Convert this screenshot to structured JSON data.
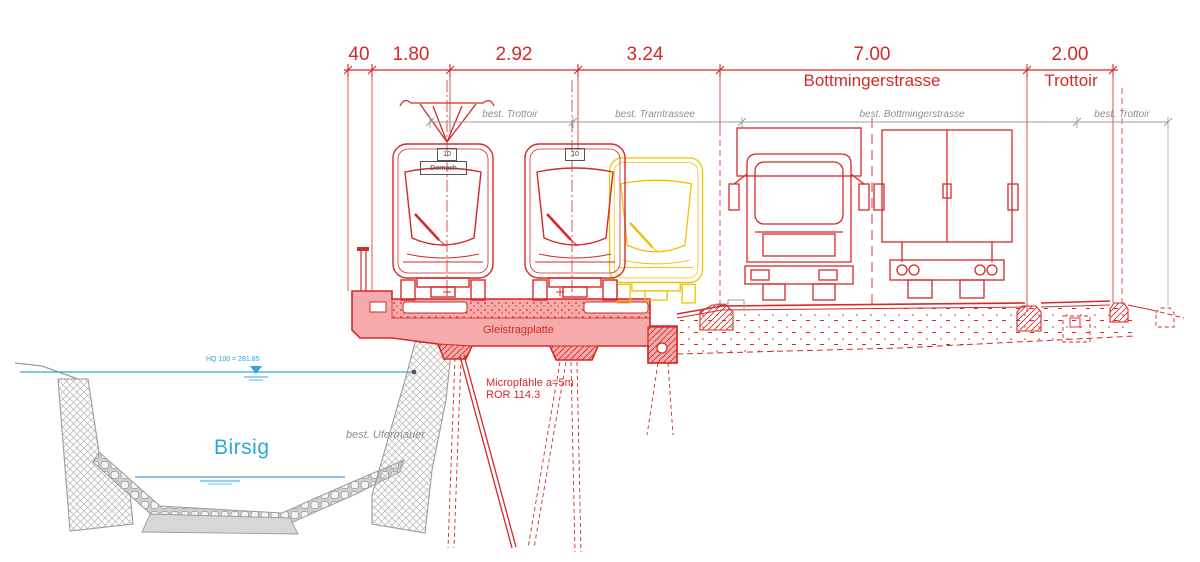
{
  "drawing": {
    "dimensions": {
      "values": [
        "40",
        "1.80",
        "2.92",
        "3.24",
        "7.00",
        "2.00"
      ],
      "street_label": "Bottmingerstrasse",
      "sidewalk_label": "Trottoir"
    },
    "existing_dimensions": {
      "labels": [
        "best. Trottoir",
        "best. Tramtrassee",
        "best. Bottmingerstrasse",
        "best. Trottoir"
      ]
    },
    "structure": {
      "slab_label": "Gleistragplatte",
      "piles_label_line1": "Micropfähle a=5m",
      "piles_label_line2": "ROR 114.3",
      "wall_label": "best. Ufermauer"
    },
    "river": {
      "name": "Birsig",
      "flood_level": "HQ 100 = 281.85"
    },
    "tram": {
      "line_number": "10",
      "destination": "Dornach",
      "line_number_2": "10"
    },
    "colors": {
      "red": "#d42a28",
      "yellow": "#eec200",
      "cyan": "#2ea6da",
      "gray": "#9c9c9c",
      "pink": "#f5abab"
    }
  }
}
